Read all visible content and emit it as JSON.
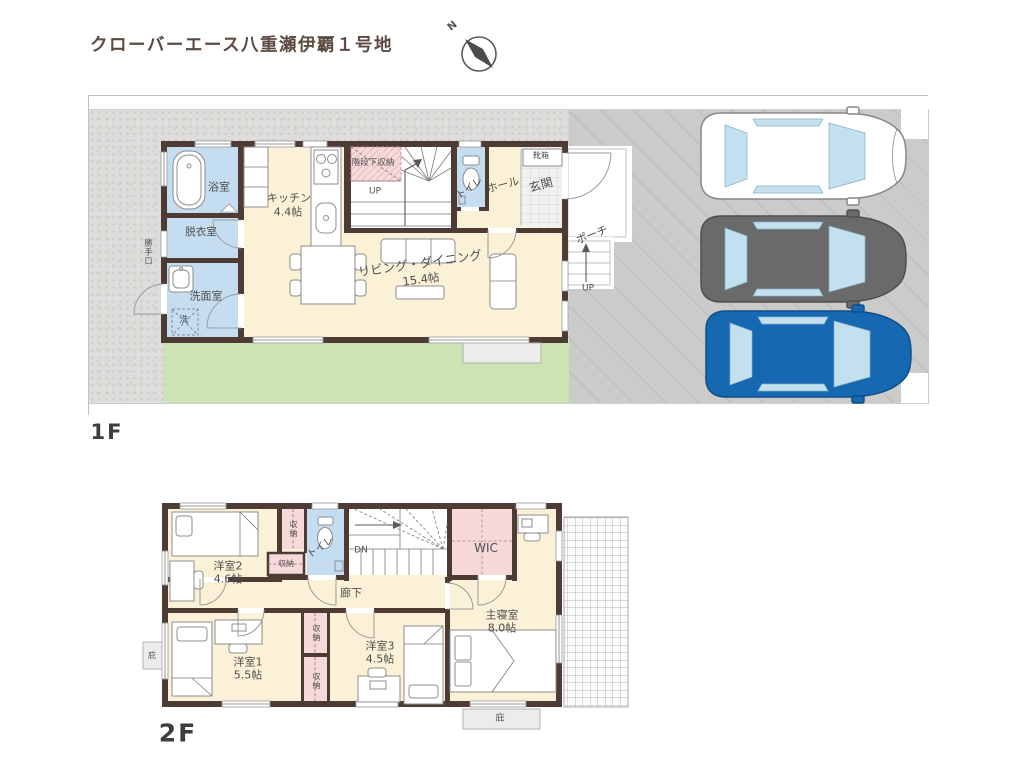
{
  "title": "クローバーエース八重瀬伊覇１号地",
  "compass": {
    "label": "N"
  },
  "floor1": {
    "label": "1F",
    "rooms": {
      "bath": "浴室",
      "dressing": "脱衣室",
      "washroom": "洗面室",
      "laundry": "洗",
      "kitchen": "キッチン",
      "kitchen_size": "4.4帖",
      "under_stair_storage": "階段下収納",
      "stairs_up": "UP",
      "toilet": "トイレ",
      "hall": "ホール",
      "entrance": "玄関",
      "shoe_box": "靴箱",
      "living_dining": "リビング・ダイニング",
      "living_dining_size": "15.4帖",
      "porch": "ポーチ",
      "porch_up": "UP",
      "back_door": "勝手口"
    }
  },
  "floor2": {
    "label": "2F",
    "rooms": {
      "room2": "洋室2",
      "room2_size": "4.6帖",
      "closet": "収納",
      "toilet": "トイレ",
      "stairs_down": "DN",
      "wic": "WIC",
      "corridor": "廊下",
      "room1": "洋室1",
      "room1_size": "5.5帖",
      "room3": "洋室3",
      "room3_size": "4.5帖",
      "master": "主寝室",
      "master_size": "8.0帖",
      "eaves": "庇"
    }
  },
  "colors": {
    "wall": "#4d3b34",
    "floor": "#faf1d7",
    "wet_area": "#c5ddf1",
    "storage_pink": "#f7d9da",
    "garden": "#cde3b4",
    "car_white": "#ffffff",
    "car_gray": "#6a6a6a",
    "car_blue": "#1668b3",
    "car_window": "#c3e0ef"
  }
}
